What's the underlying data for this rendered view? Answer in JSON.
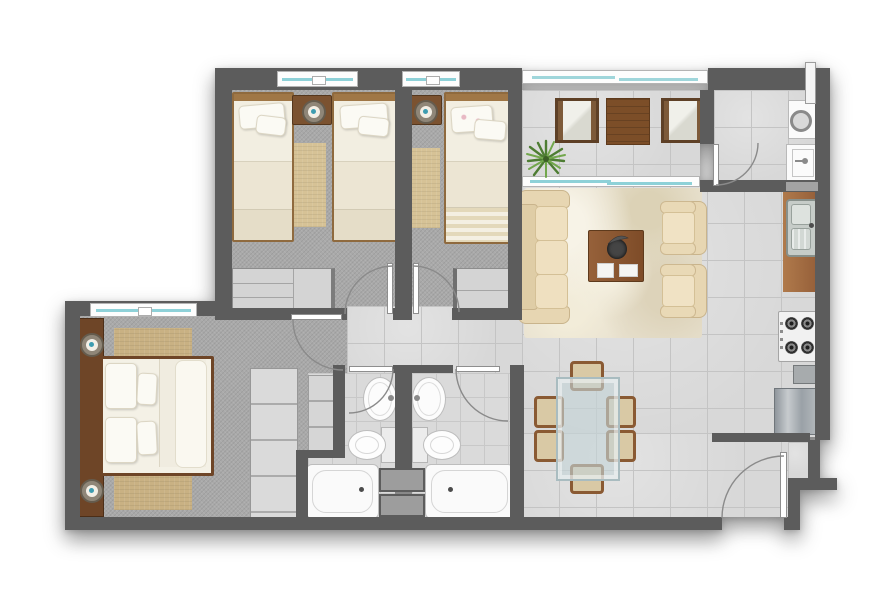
{
  "document": {
    "kind": "apartment floor plan (top-down 2D architectural render)",
    "background": "#ffffff",
    "visible_text": "none"
  },
  "palette": {
    "wall": "#5c5c5c",
    "carpet": "#a9a9a9",
    "tile": "#d8d8d8",
    "tile_grout": "#c4c4c4",
    "wood_dark": "#6e4527",
    "wood_mid": "#9a7244",
    "bedding_cream": "#f2eee1",
    "rug_tan": "#c9b183",
    "rug_shag_cream": "#e8e1cf",
    "upholstery_beige": "#e9d9b6",
    "glass_teal": "#8ed1d8",
    "fixture_white": "#fbfbfb",
    "appliance_gray": "#aab0b5",
    "duct_gray": "#9d9d9d",
    "plant_green": "#5c8a3c"
  },
  "rooms": [
    {
      "name": "bedroom-1",
      "furniture": [
        "single-bed",
        "single-bed",
        "nightstand-with-lamp",
        "runner-rug",
        "dresser",
        "window",
        "swing-door"
      ]
    },
    {
      "name": "bedroom-2",
      "furniture": [
        "single-bed",
        "nightstand-with-lamp",
        "runner-rug",
        "dresser",
        "window",
        "swing-door"
      ]
    },
    {
      "name": "master-bedroom",
      "furniture": [
        "double-bed",
        "headboard-unit-with-two-lamps",
        "area-rug",
        "sliding-door-closet",
        "shelving-unit",
        "window",
        "swing-door"
      ]
    },
    {
      "name": "bathroom-1",
      "furniture": [
        "wall-sink",
        "toilet",
        "bathtub",
        "swing-door"
      ]
    },
    {
      "name": "bathroom-2",
      "furniture": [
        "wall-sink",
        "toilet",
        "bathtub",
        "swing-door"
      ]
    },
    {
      "name": "hallway",
      "furniture": []
    },
    {
      "name": "living-room",
      "furniture": [
        "three-seat-sofa",
        "shag-rug",
        "coffee-table-with-tray-and-books",
        "armchair",
        "armchair"
      ]
    },
    {
      "name": "dining-area",
      "furniture": [
        "glass-dining-table",
        "dining-chair",
        "dining-chair",
        "dining-chair",
        "dining-chair",
        "dining-chair",
        "dining-chair"
      ]
    },
    {
      "name": "kitchen",
      "furniture": [
        "counter-with-double-sink",
        "gas-cooktop-4-burners",
        "base-cabinet",
        "refrigerator"
      ]
    },
    {
      "name": "balcony",
      "furniture": [
        "lounge-chair",
        "wood-side-table",
        "lounge-chair",
        "potted-plant",
        "glass-railing",
        "sliding-glass-door"
      ]
    },
    {
      "name": "laundry-room",
      "furniture": [
        "washing-machine",
        "laundry-sink",
        "vent-pipe",
        "swing-door"
      ]
    },
    {
      "name": "entry",
      "furniture": [
        "entry-swing-door"
      ]
    }
  ],
  "counts": {
    "bedrooms": 3,
    "bathrooms": 2,
    "single_beds": 3,
    "double_beds": 1,
    "dining_chairs": 6,
    "doors_swing": 7,
    "windows": 3
  }
}
